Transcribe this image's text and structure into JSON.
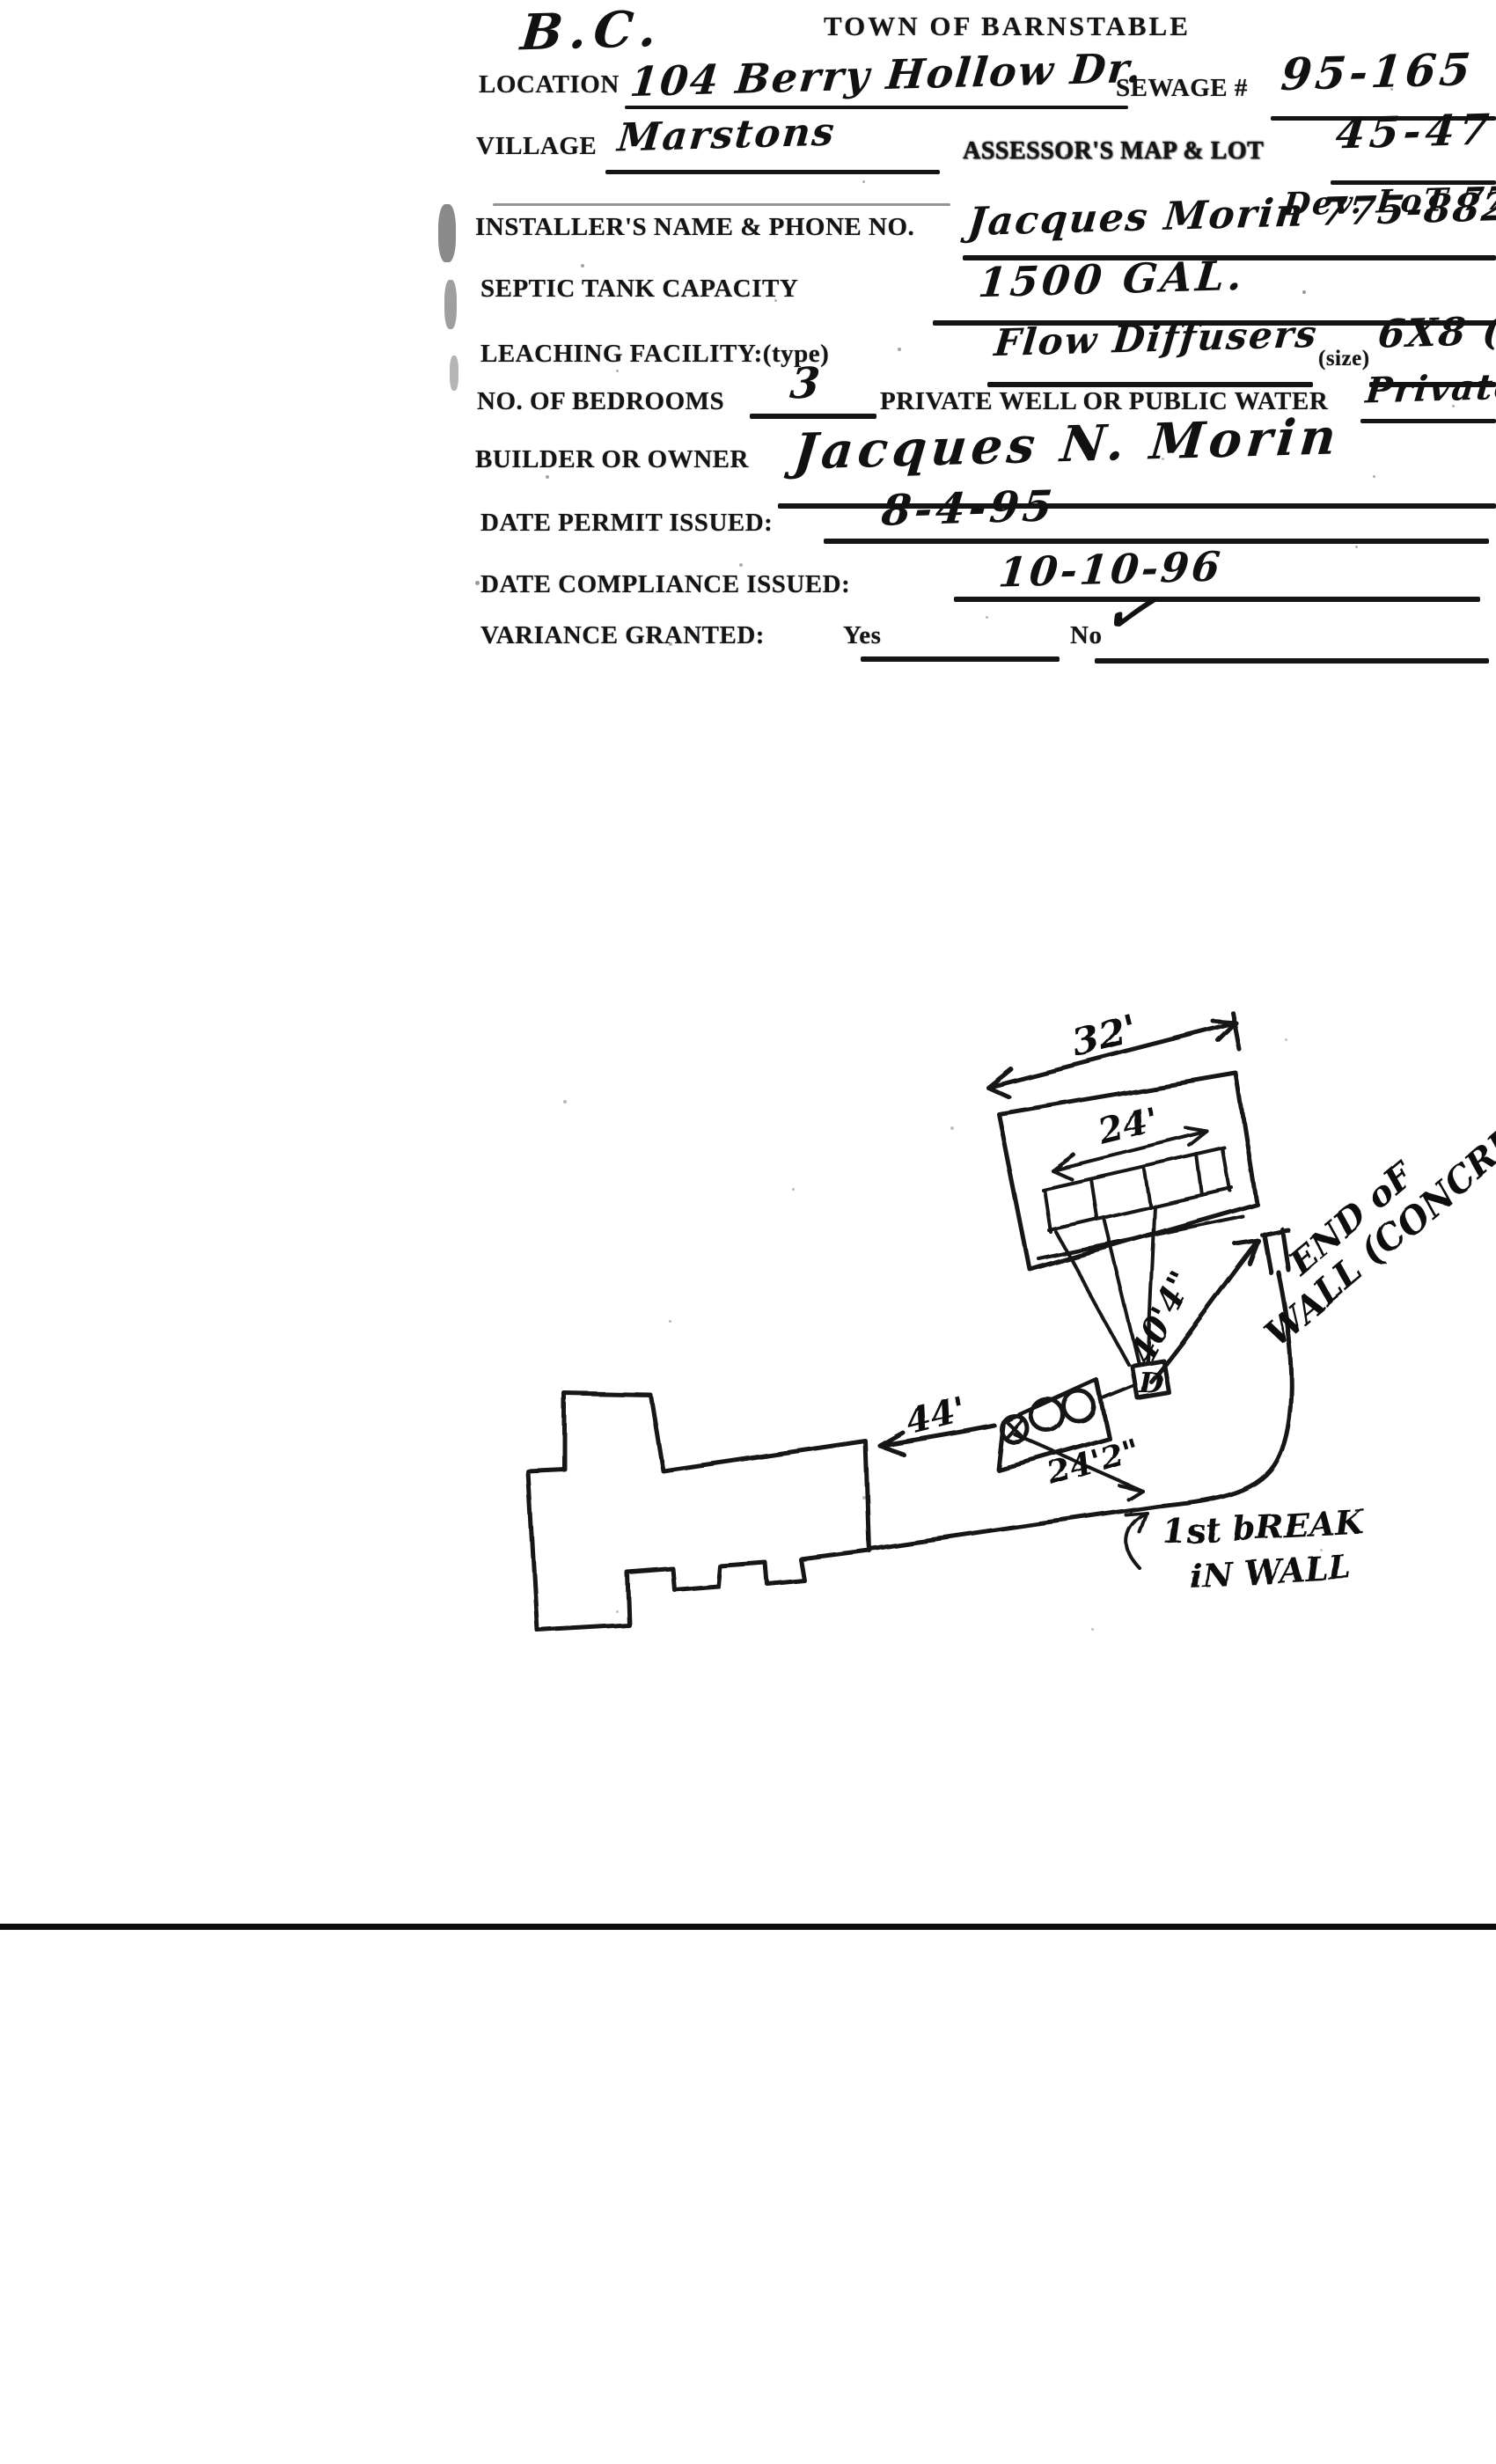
{
  "header": {
    "corner_note": "B.C.",
    "title": "TOWN OF BARNSTABLE"
  },
  "form": {
    "location": {
      "label": "LOCATION",
      "value": "104 Berry Hollow Dr."
    },
    "sewage": {
      "label": "SEWAGE #",
      "value": "95-165"
    },
    "village": {
      "label": "VILLAGE",
      "value": "Marstons"
    },
    "assessors": {
      "label": "ASSESSOR'S MAP & LOT",
      "value": "45-47"
    },
    "dev_lot": {
      "value": "Dev. LoT 77"
    },
    "installer": {
      "label": "INSTALLER'S NAME & PHONE NO.",
      "value": "Jacques Morin 775-8822"
    },
    "septic": {
      "label": "SEPTIC TANK CAPACITY",
      "value": "1500 GAL."
    },
    "leaching": {
      "label": "LEACHING FACILITY:(type)",
      "value": "Flow Diffusers",
      "size_label": "(size)",
      "size_value": "6X8 (3)"
    },
    "bedrooms": {
      "label": "NO. OF BEDROOMS",
      "value": "3"
    },
    "water": {
      "label": "PRIVATE WELL OR PUBLIC WATER",
      "value": "Private"
    },
    "builder": {
      "label": "BUILDER OR OWNER",
      "value": "Jacques N. Morin"
    },
    "permit": {
      "label": "DATE PERMIT ISSUED:",
      "value": "8-4-95"
    },
    "compliance": {
      "label": "DATE  COMPLIANCE ISSUED:",
      "value": "10-10-96"
    },
    "variance": {
      "label": "VARIANCE GRANTED:",
      "yes_label": "Yes",
      "no_label": "No",
      "no_mark": "✓"
    }
  },
  "sketch": {
    "dim_field_outer": "32'",
    "dim_field_inner": "24'",
    "dim_dbox_to_wall": "40'4\"",
    "dim_house_to_tank": "44'",
    "dim_tank_to_break": "24'2\"",
    "distribution_box_label": "D",
    "end_of_wall_note_line1": "END oF",
    "end_of_wall_note_line2": "WALL (CONCRET",
    "break_note_line1": "1st bREAK",
    "break_note_line2": "iN WALL"
  },
  "ink_color": "#141414"
}
